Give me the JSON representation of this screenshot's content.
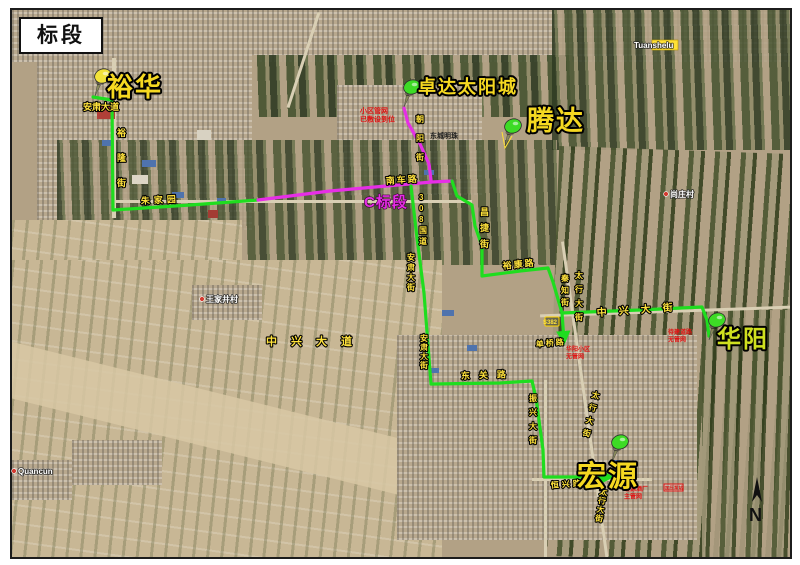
{
  "title": {
    "label": "标段"
  },
  "compass": {
    "letter": "N"
  },
  "colors": {
    "route_green": "#1fdd1f",
    "route_magenta": "#e62ee6",
    "pin_green": "#3ddb25",
    "pin_yellow": "#f2e23a",
    "street_yellow": "#ffe23c",
    "note_red": "#e01313"
  },
  "pins": [
    {
      "id": "yuhua",
      "label": "裕华",
      "tip_x": 95,
      "tip_y": 96,
      "color": "#f2e23a",
      "label_color": "#f5d821",
      "label_x": 107,
      "label_y": 96,
      "label_size": 26
    },
    {
      "id": "zhuoda",
      "label": "卓达太阳城",
      "tip_x": 404,
      "tip_y": 107,
      "color": "#3ddb25",
      "label_color": "#f5d821",
      "label_x": 418,
      "label_y": 93,
      "label_size": 18
    },
    {
      "id": "tengda",
      "label": "腾达",
      "tip_x": 505,
      "tip_y": 146,
      "color": "#3ddb25",
      "label_color": "#f5d821",
      "label_x": 527,
      "label_y": 130,
      "label_size": 27,
      "tail": true
    },
    {
      "id": "huayang",
      "label": "华阳",
      "tip_x": 709,
      "tip_y": 340,
      "color": "#3ddb25",
      "label_color": "#cfe01f",
      "label_x": 717,
      "label_y": 347,
      "label_size": 24
    },
    {
      "id": "hongyuan",
      "label": "宏源",
      "tip_x": 612,
      "tip_y": 462,
      "color": "#3ddb25",
      "label_color": "#f5d821",
      "label_x": 577,
      "label_y": 486,
      "label_size": 29
    }
  ],
  "routes": [
    {
      "id": "yuhua-west-green",
      "color": "green",
      "points": [
        [
          93,
          97
        ],
        [
          112,
          100
        ],
        [
          113,
          210
        ],
        [
          190,
          205
        ],
        [
          258,
          200
        ]
      ]
    },
    {
      "id": "c-section-magenta",
      "color": "magenta",
      "points": [
        [
          258,
          200
        ],
        [
          330,
          191
        ],
        [
          432,
          182
        ],
        [
          452,
          181
        ]
      ]
    },
    {
      "id": "zhuoda-feeder-magenta",
      "color": "magenta",
      "points": [
        [
          404,
          108
        ],
        [
          408,
          123
        ],
        [
          420,
          144
        ],
        [
          429,
          164
        ],
        [
          431,
          180
        ]
      ]
    },
    {
      "id": "east-green",
      "color": "green",
      "arrow": true,
      "points": [
        [
          452,
          181
        ],
        [
          457,
          196
        ],
        [
          472,
          205
        ],
        [
          475,
          226
        ],
        [
          482,
          246
        ],
        [
          482,
          276
        ],
        [
          520,
          271
        ],
        [
          548,
          268
        ],
        [
          553,
          282
        ],
        [
          560,
          306
        ],
        [
          562,
          313
        ],
        [
          564,
          341
        ]
      ]
    },
    {
      "id": "huayang-branch-green",
      "color": "green",
      "points": [
        [
          562,
          313
        ],
        [
          640,
          310
        ],
        [
          702,
          307
        ],
        [
          707,
          320
        ],
        [
          709,
          336
        ]
      ]
    },
    {
      "id": "south-green",
      "color": "green",
      "arrow": true,
      "points": [
        [
          411,
          186
        ],
        [
          417,
          238
        ],
        [
          424,
          293
        ],
        [
          431,
          384
        ],
        [
          500,
          383
        ],
        [
          532,
          381
        ],
        [
          536,
          398
        ],
        [
          543,
          450
        ],
        [
          544,
          477
        ],
        [
          610,
          477
        ]
      ]
    }
  ],
  "route_label": {
    "text": "C标段",
    "x": 364,
    "y": 207,
    "size": 15
  },
  "street_labels": [
    {
      "text": "安肃大道",
      "x": 83,
      "y": 110,
      "size": 9
    },
    {
      "text": "裕隆街",
      "x": 117,
      "y": 136,
      "size": 9,
      "vertical": true,
      "gap": 25
    },
    {
      "text": "朱家园",
      "x": 141,
      "y": 204,
      "size": 9,
      "ls": 4,
      "rotate": -3
    },
    {
      "text": "朝阳街",
      "x": 416,
      "y": 122,
      "size": 8,
      "vertical": true,
      "gap": 19
    },
    {
      "text": "南车路",
      "x": 386,
      "y": 184,
      "size": 9,
      "ls": 2,
      "rotate": -4
    },
    {
      "text": "308国道",
      "x": 419,
      "y": 200,
      "size": 8,
      "vertical": true,
      "gap": 11
    },
    {
      "text": "昌捷街",
      "x": 480,
      "y": 215,
      "size": 9,
      "vertical": true,
      "gap": 16
    },
    {
      "text": "裕康路",
      "x": 503,
      "y": 269,
      "size": 9,
      "ls": 2,
      "rotate": -6
    },
    {
      "text": "安肃大街",
      "x": 407,
      "y": 260,
      "size": 8,
      "vertical": true,
      "gap": 10
    },
    {
      "text": "安肃大街",
      "x": 420,
      "y": 341,
      "size": 8,
      "vertical": true,
      "gap": 9
    },
    {
      "text": "中兴大道",
      "x": 266,
      "y": 345,
      "size": 11,
      "ls": 14
    },
    {
      "text": "秦知街",
      "x": 561,
      "y": 281,
      "size": 8,
      "vertical": true,
      "gap": 12
    },
    {
      "text": "太行大街",
      "x": 575,
      "y": 278,
      "size": 8,
      "vertical": true,
      "gap": 14
    },
    {
      "text": "中兴大街",
      "x": 597,
      "y": 316,
      "size": 10,
      "ls": 12,
      "rotate": -4
    },
    {
      "text": "单桥路",
      "x": 536,
      "y": 347,
      "size": 8,
      "ls": 2,
      "rotate": -5
    },
    {
      "text": "东关路",
      "x": 461,
      "y": 379,
      "size": 9,
      "ls": 9,
      "rotate": -2
    },
    {
      "text": "振兴大街",
      "x": 529,
      "y": 401,
      "size": 8,
      "vertical": true,
      "gap": 14
    },
    {
      "text": "太行大街",
      "x": 591,
      "y": 397,
      "size": 8,
      "vertical": true,
      "gap": 13,
      "rotate": 13
    },
    {
      "text": "恒兴路",
      "x": 551,
      "y": 488,
      "size": 8,
      "ls": 3,
      "rotate": -4
    },
    {
      "text": "太行大街",
      "x": 599,
      "y": 494,
      "size": 8,
      "vertical": true,
      "gap": 9,
      "rotate": 9
    }
  ],
  "red_notes": [
    {
      "lines": [
        "小区管网",
        "已敷设到位"
      ],
      "x": 360,
      "y": 113,
      "size": 7
    },
    {
      "lines": [
        "华阳小区",
        "无管网"
      ],
      "x": 566,
      "y": 351,
      "size": 6
    },
    {
      "lines": [
        "待建道路",
        "无管网"
      ],
      "x": 668,
      "y": 334,
      "size": 6
    },
    {
      "lines": [
        "宏源酒厂",
        "主管网"
      ],
      "x": 624,
      "y": 491,
      "size": 6
    }
  ],
  "dark_notes": [
    {
      "text": "东城明珠",
      "x": 430,
      "y": 138,
      "size": 7
    }
  ],
  "shields": [
    {
      "text": "S382",
      "x": 545,
      "y": 317,
      "w": 14,
      "h": 9
    }
  ],
  "red_box": {
    "text": "加压泵站",
    "x": 664,
    "y": 484,
    "w": 19,
    "h": 7
  },
  "base_labels": [
    {
      "text": "王家井村",
      "x": 206,
      "y": 302,
      "size": 8,
      "dot": true
    },
    {
      "text": "尚庄村",
      "x": 670,
      "y": 197,
      "size": 8,
      "dot": true
    },
    {
      "text": "Quancun",
      "x": 18,
      "y": 474,
      "size": 8,
      "dot": true
    },
    {
      "text": "Tuanshelu",
      "x": 634,
      "y": 48,
      "size": 8,
      "highlight": true
    }
  ]
}
